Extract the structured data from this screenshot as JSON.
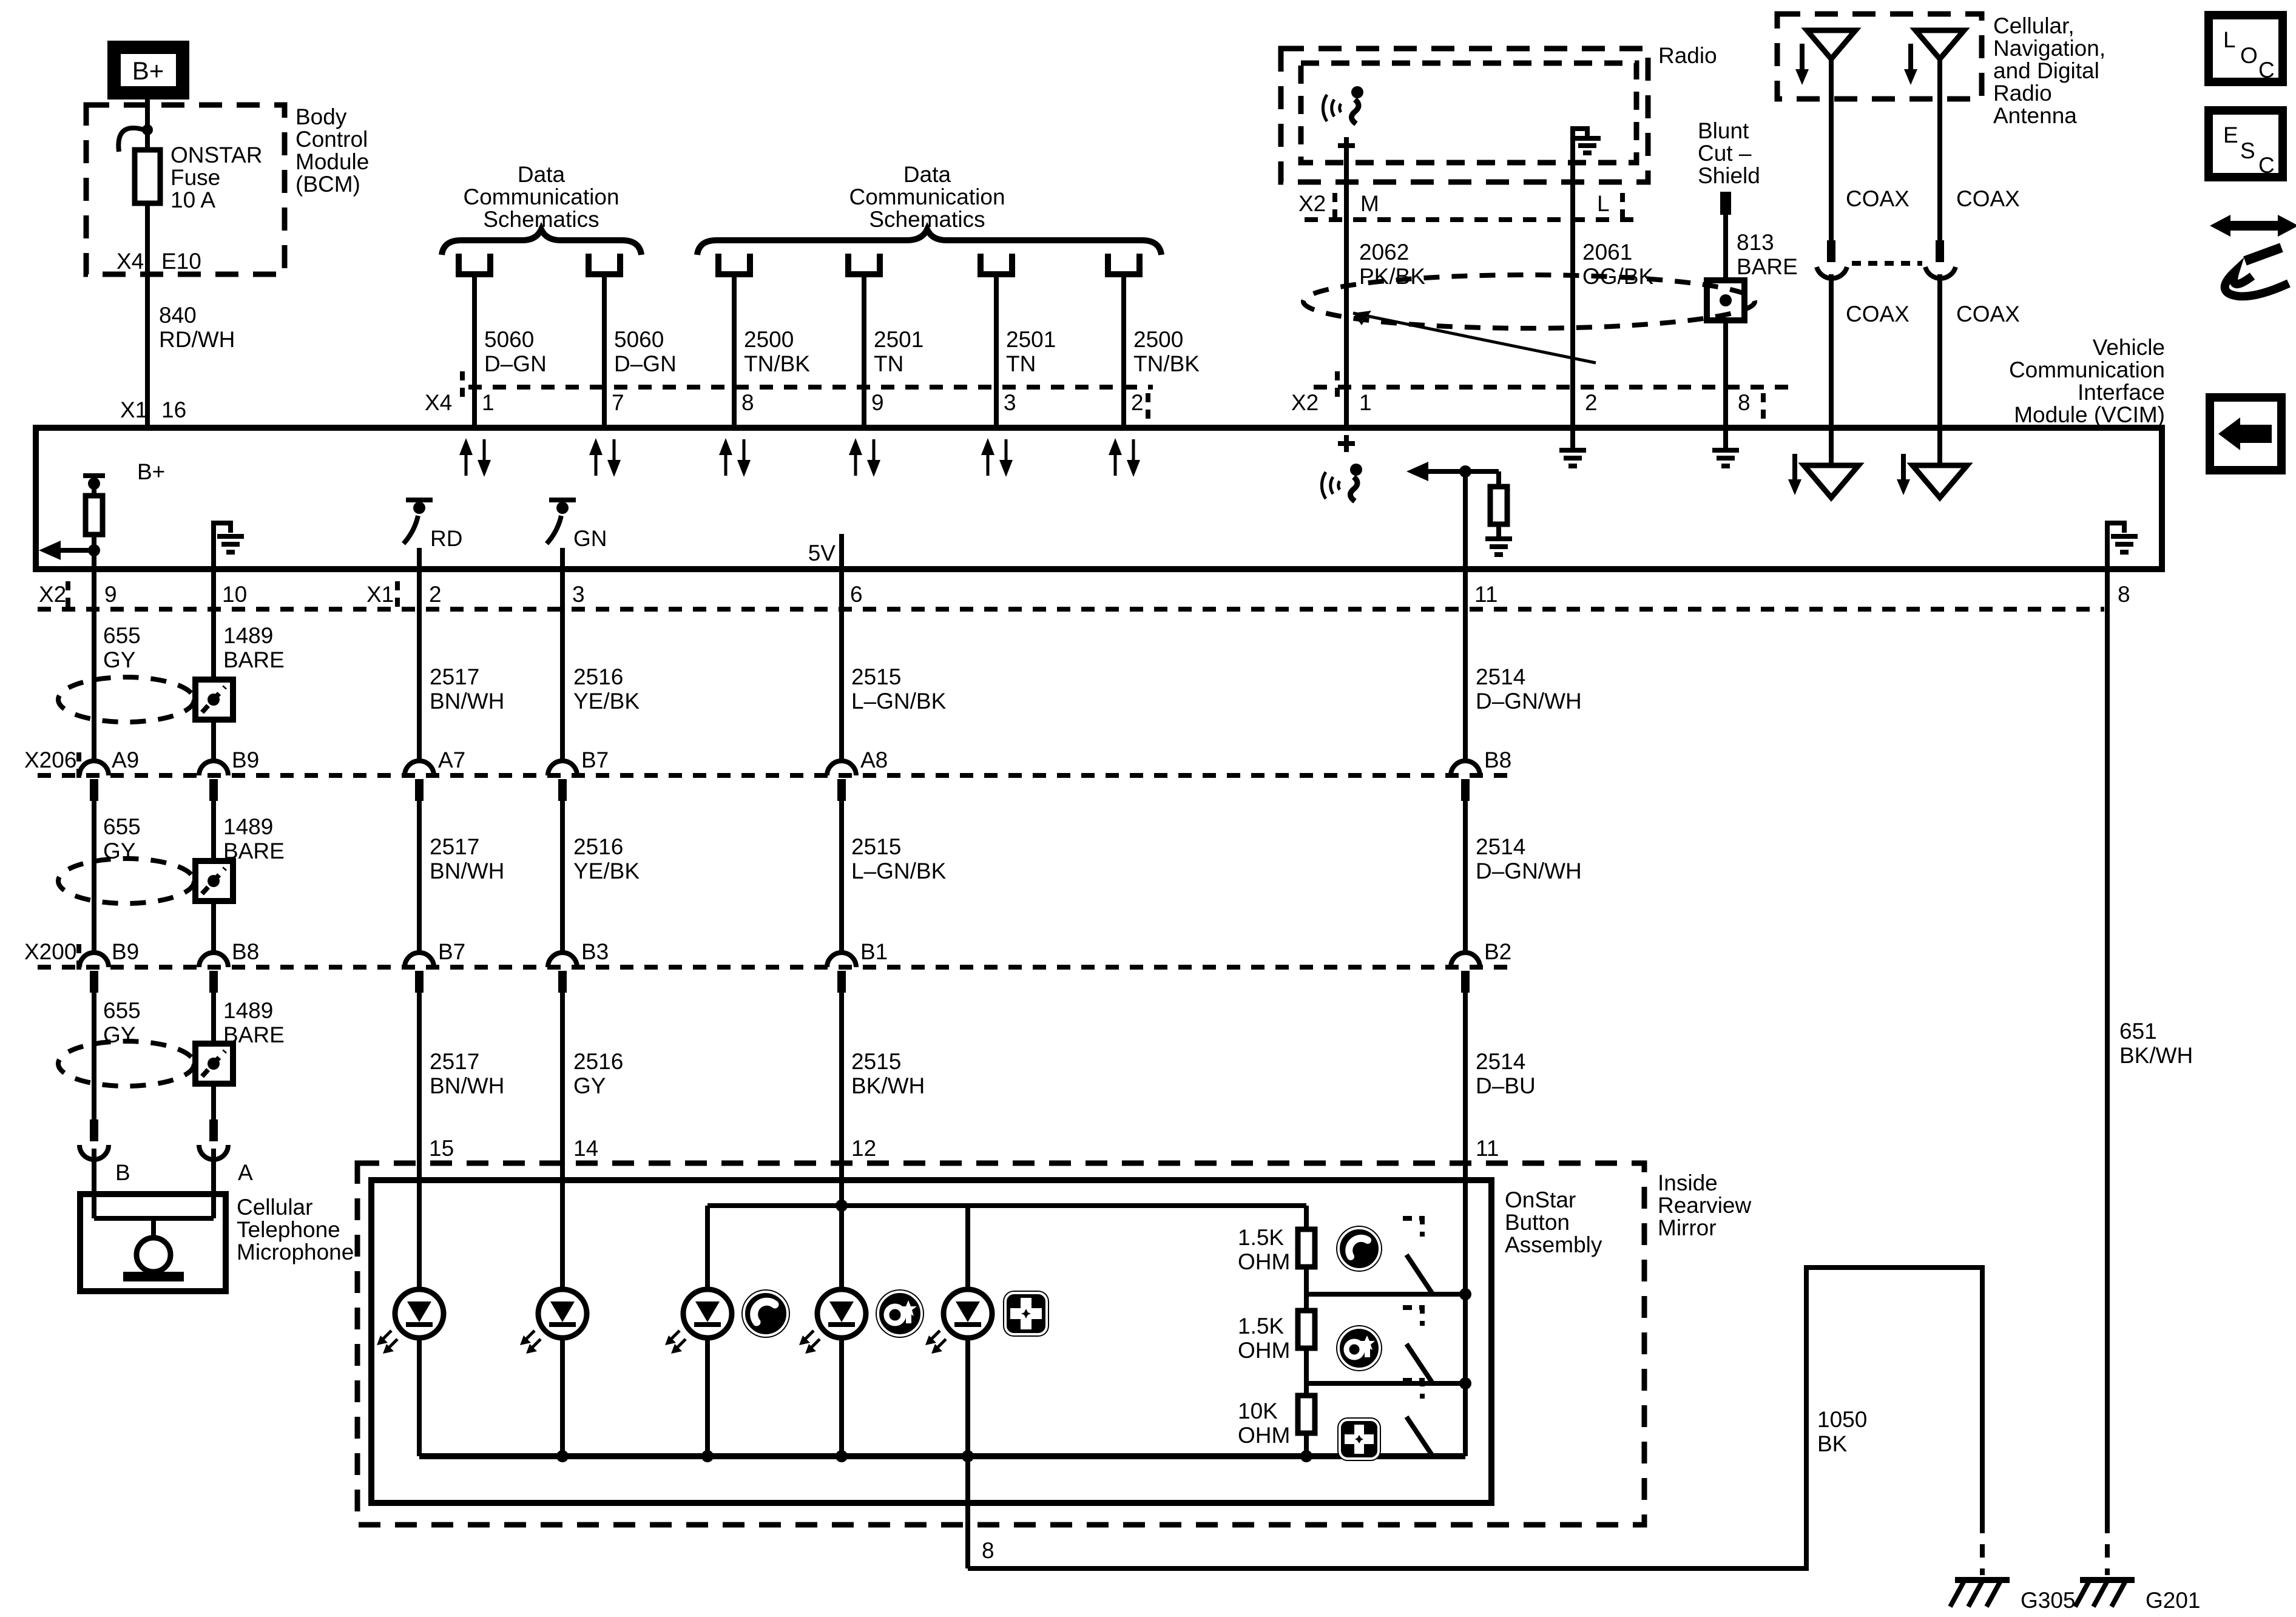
{
  "labels": {
    "bplus": "B+",
    "radio": "Radio",
    "rd": "RD",
    "gn": "GN",
    "fivev": "5V",
    "bcm": [
      "Body",
      "Control",
      "Module",
      "(BCM)"
    ],
    "fuse": [
      "ONSTAR",
      "Fuse",
      "10 A"
    ],
    "dcs": [
      "Data",
      "Communication",
      "Schematics"
    ],
    "antenna": [
      "Cellular,",
      "Navigation,",
      "and Digital",
      "Radio",
      "Antenna"
    ],
    "vcim": [
      "Vehicle",
      "Communication",
      "Interface",
      "Module (VCIM)"
    ],
    "blunt": [
      "Blunt",
      "Cut –",
      "Shield"
    ],
    "mic": [
      "Cellular",
      "Telephone",
      "Microphone"
    ],
    "mirror": [
      "Inside",
      "Rearview",
      "Mirror"
    ],
    "onstar": [
      "OnStar",
      "Button",
      "Assembly"
    ],
    "loc": [
      "L",
      "O",
      "C"
    ],
    "esc": [
      "E",
      "S",
      "C"
    ],
    "r1": [
      "1.5K",
      "OHM"
    ],
    "r2": [
      "1.5K",
      "OHM"
    ],
    "r3": [
      "10K",
      "OHM"
    ],
    "g305": "G305",
    "g201": "G201"
  },
  "wires": {
    "w840": [
      "840",
      "RD/WH"
    ],
    "w5060": [
      "5060",
      "D–GN"
    ],
    "w2500": [
      "2500",
      "TN/BK"
    ],
    "w2501": [
      "2501",
      "TN"
    ],
    "w2062": [
      "2062",
      "PK/BK"
    ],
    "w2061": [
      "2061",
      "OG/BK"
    ],
    "w813": [
      "813",
      "BARE"
    ],
    "coax": "COAX",
    "w655": [
      "655",
      "GY"
    ],
    "w1489": [
      "1489",
      "BARE"
    ],
    "w2517": [
      "2517",
      "BN/WH"
    ],
    "w2516": [
      "2516",
      "YE/BK"
    ],
    "w2516b": [
      "2516",
      "GY"
    ],
    "w2515": [
      "2515",
      "L–GN/BK"
    ],
    "w2515b": [
      "2515",
      "BK/WH"
    ],
    "w2514": [
      "2514",
      "D–GN/WH"
    ],
    "w2514b": [
      "2514",
      "D–BU"
    ],
    "w1050": [
      "1050",
      "BK"
    ],
    "w651": [
      "651",
      "BK/WH"
    ]
  },
  "connectors": {
    "x1": "X1",
    "x2": "X2",
    "x4": "X4",
    "x206": "X206",
    "x200": "X200",
    "e10": "E10",
    "p16": "16",
    "data_pins": [
      "1",
      "7",
      "8",
      "9",
      "3",
      "2"
    ],
    "radio_pins": [
      "M",
      "L"
    ],
    "radio_vcim_pins": [
      "1",
      "2",
      "8"
    ],
    "left_pins": [
      "9",
      "10"
    ],
    "x1_pins": [
      "2",
      "3",
      "6",
      "11",
      "8"
    ],
    "x206_pins": [
      "A9",
      "B9",
      "A7",
      "B7",
      "A8",
      "B8"
    ],
    "x200_pins": [
      "B9",
      "B8",
      "B7",
      "B3",
      "B1",
      "B2"
    ],
    "mic_pins": [
      "B",
      "A"
    ],
    "assy_pins": [
      "15",
      "14",
      "12",
      "11"
    ],
    "assy_pin8": "8"
  }
}
